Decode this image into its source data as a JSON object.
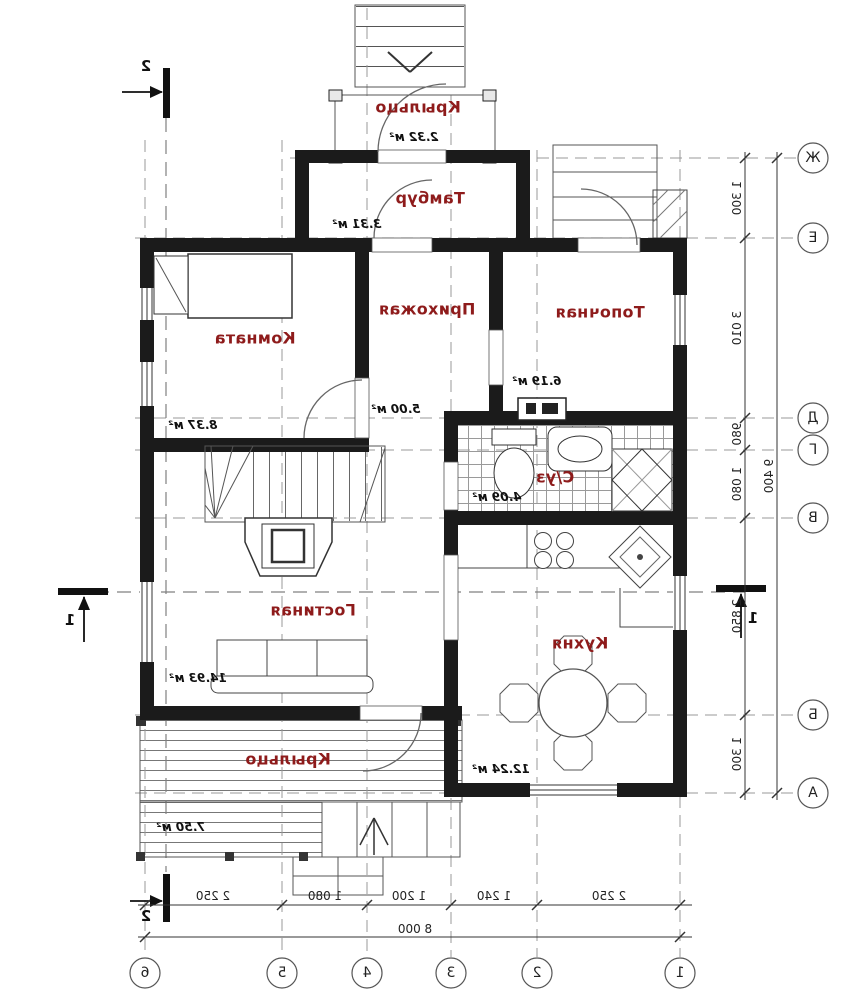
{
  "rooms": {
    "porch_top": {
      "name": "Крыльцо",
      "area": "2.32 м²"
    },
    "tambour": {
      "name": "Тамбур",
      "area": "3.31 м²"
    },
    "hallway": {
      "name": "Прихожая",
      "area": "5.00 м²"
    },
    "boiler": {
      "name": "Топочная",
      "area": "6.19 м²"
    },
    "room": {
      "name": "Комната",
      "area": "8.37 м²"
    },
    "bathroom": {
      "name": "С/уз",
      "area": "4.09 м²"
    },
    "living": {
      "name": "Гостиная",
      "area": "14.93 м²"
    },
    "kitchen": {
      "name": "Кухня",
      "area": "12.24 м²"
    },
    "porch_bottom": {
      "name": "Крыльцо",
      "area": "7.50 м²"
    }
  },
  "dims": {
    "bottom": [
      "2 250",
      "1 080",
      "1 200",
      "1 240",
      "2 250"
    ],
    "bottom_total": "8 000",
    "right": [
      "1 300",
      "3 010",
      "980",
      "1 080",
      "2 850",
      "1 300"
    ],
    "right_total": "9 400"
  },
  "axes": {
    "horizontal": [
      "Ж",
      "Е",
      "Д",
      "Г",
      "В",
      "Б",
      "А"
    ],
    "vertical": [
      "6",
      "5",
      "4",
      "3",
      "2",
      "1"
    ]
  },
  "sections": {
    "top": "2",
    "bottom": "2",
    "left": "1",
    "right": "1"
  },
  "colors": {
    "room_label": "#8e1b1b",
    "wall": "#1b1b1b",
    "thin_line": "#444444",
    "grid": "#9a9a9a"
  }
}
